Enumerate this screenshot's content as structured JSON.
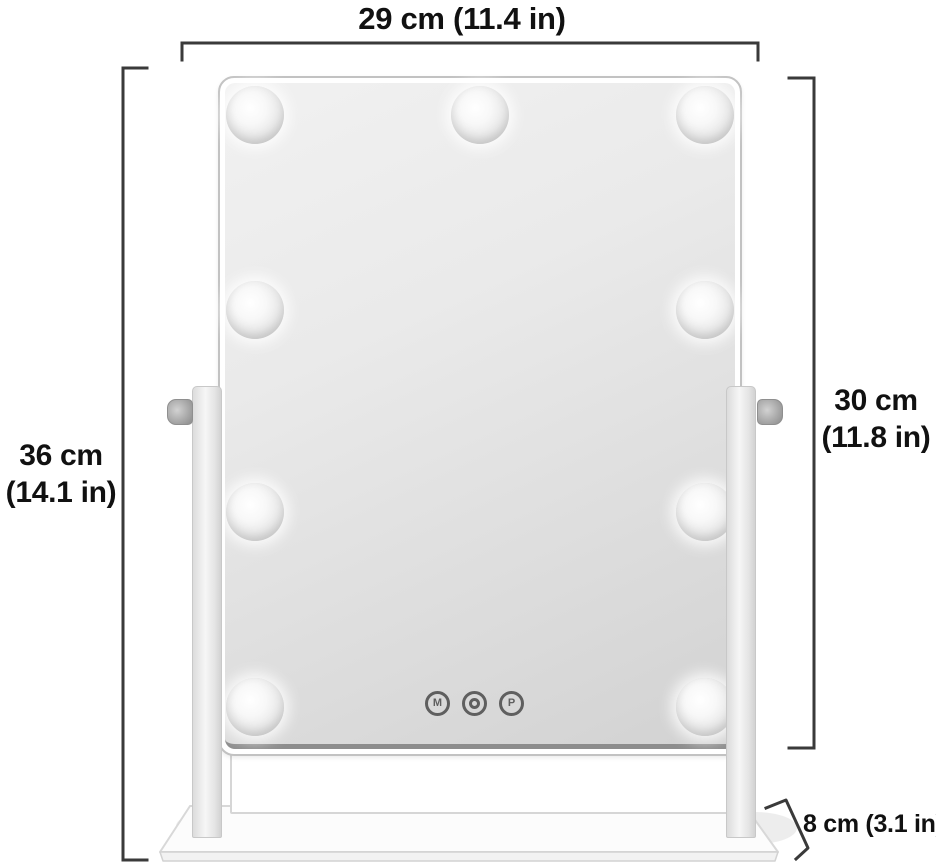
{
  "diagram": {
    "type": "product dimension diagram",
    "subject": "Hollywood lighted vanity mirror on swivel stand",
    "dimensions": {
      "width": {
        "label": "29 cm (11.4 in)",
        "position": "top"
      },
      "total_height": {
        "line1": "36 cm",
        "line2": "(14.1 in)",
        "position": "left"
      },
      "mirror_height": {
        "line1": "30 cm",
        "line2": "(11.8 in)",
        "position": "right"
      },
      "base_depth": {
        "label": "8 cm (3.1 in)",
        "position": "bottom-right"
      }
    },
    "mirror": {
      "bulb_count": 9,
      "controls": [
        {
          "label": "M"
        },
        {
          "icon": "power-ring-icon"
        },
        {
          "label": "P"
        }
      ]
    },
    "colors": {
      "dimension_line": "#3a3a3a",
      "label_text": "#111111",
      "frame": "#ffffff",
      "glass_light": "#f1f1f1",
      "glass_dark": "#d2d2d2",
      "background": "#ffffff"
    }
  }
}
